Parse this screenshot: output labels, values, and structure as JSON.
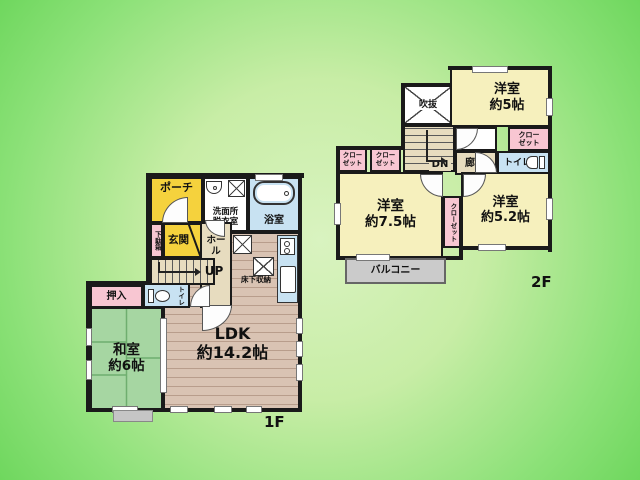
{
  "title": "2-story house floor plan",
  "colors": {
    "background_center": "#d9f3c0",
    "background_edge": "#6fd75e",
    "wall": "#1a1a1a",
    "entrance_yellow": "#f5d23d",
    "room_pale_yellow": "#f6f0bd",
    "closet_pink": "#f8c6d2",
    "tatami_green": "#a6d6a2",
    "wood_floor": "#d9c3b3",
    "hall_beige": "#e7dcbf",
    "water_area_blue": "#c8e2f2",
    "balcony_gray": "#cbcbcb"
  },
  "floor1": {
    "floor_label": "1F",
    "porch": "ポーチ",
    "washroom": "洗面所\n脱衣室",
    "bathroom": "浴室",
    "shoe_cabinet": "下駄箱",
    "entrance": "玄関",
    "hall": "ホール",
    "stairs_up": "UP",
    "underfloor_storage": "床下収納",
    "toilet": "トイレ",
    "oshiire_closet": "押入",
    "japanese_room": "和室\n約6帖",
    "ldk": "LDK\n約14.2帖"
  },
  "floor2": {
    "floor_label": "2F",
    "void_atrium": "吹抜",
    "western_room_5": "洋室\n約5帖",
    "closet_right": "クロー\nゼット",
    "toilet": "トイレ",
    "stairs_down": "DN",
    "corridor": "廊下",
    "closet_left_1": "クロー\nゼット",
    "closet_left_2": "クロー\nゼット",
    "western_room_7_5": "洋室\n約7.5帖",
    "closet_center": "クローゼット",
    "western_room_5_2": "洋室\n約5.2帖",
    "balcony": "バルコニー"
  }
}
